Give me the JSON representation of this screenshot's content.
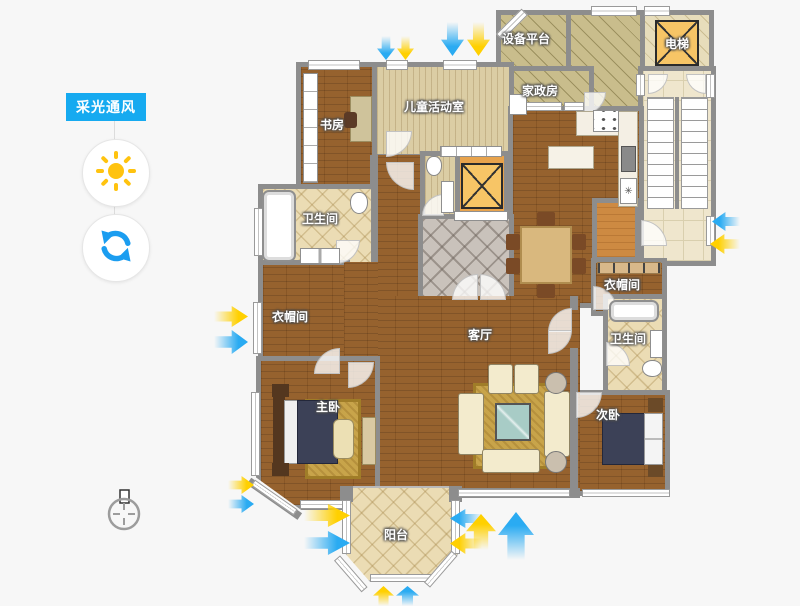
{
  "mode_panel": {
    "label": "采光通风",
    "buttons": [
      {
        "name": "sun",
        "meaning": "daylight"
      },
      {
        "name": "refresh",
        "meaning": "refresh"
      }
    ]
  },
  "colors": {
    "accent_blue": "#16aaf0",
    "daylight_arrow": "#ffd000",
    "wind_arrow": "#2aabf2",
    "wall_gray": "#8d8d8d",
    "elevator_fill": "#f7c566"
  },
  "rooms": {
    "equipment_platform": {
      "label": "设备平台"
    },
    "elevator": {
      "label": "电梯"
    },
    "housekeeping": {
      "label": "家政房"
    },
    "kids_room": {
      "label": "儿童活动室"
    },
    "study": {
      "label": "书房"
    },
    "bathroom1": {
      "label": "卫生间"
    },
    "cloakroom1": {
      "label": "衣帽间"
    },
    "living_room": {
      "label": "客厅"
    },
    "cloakroom2": {
      "label": "衣帽间"
    },
    "bathroom2": {
      "label": "卫生间"
    },
    "master_bedroom": {
      "label": "主卧"
    },
    "second_bedroom": {
      "label": "次卧"
    },
    "balcony": {
      "label": "阳台"
    }
  },
  "arrows": [
    {
      "direction": "down",
      "color": "yellow"
    },
    {
      "direction": "down",
      "color": "blue"
    },
    {
      "direction": "down",
      "color": "yellow"
    },
    {
      "direction": "down",
      "color": "blue"
    },
    {
      "direction": "left",
      "color": "blue"
    },
    {
      "direction": "left",
      "color": "yellow"
    },
    {
      "direction": "right",
      "color": "yellow"
    },
    {
      "direction": "right",
      "color": "blue"
    },
    {
      "direction": "right",
      "color": "yellow"
    },
    {
      "direction": "right",
      "color": "blue"
    },
    {
      "direction": "right",
      "color": "yellow"
    },
    {
      "direction": "right",
      "color": "blue"
    },
    {
      "direction": "left",
      "color": "blue"
    },
    {
      "direction": "up",
      "color": "yellow"
    },
    {
      "direction": "left",
      "color": "yellow"
    },
    {
      "direction": "up",
      "color": "blue"
    },
    {
      "direction": "up",
      "color": "yellow"
    },
    {
      "direction": "up",
      "color": "blue"
    }
  ],
  "compass": {
    "visible": true
  }
}
